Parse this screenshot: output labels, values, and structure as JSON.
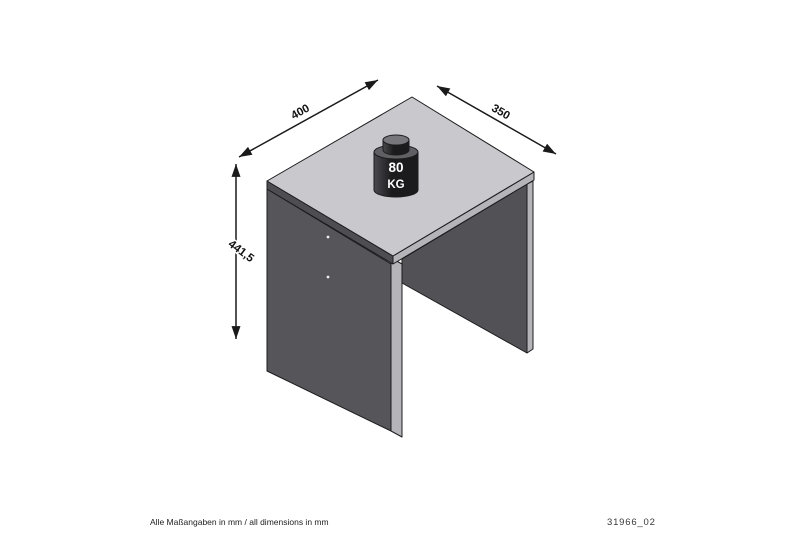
{
  "drawing": {
    "title": "stool isometric dimension drawing",
    "dimensions": {
      "width": {
        "label": "400"
      },
      "depth": {
        "label": "350"
      },
      "height": {
        "label": "441,5"
      }
    },
    "load_capacity": {
      "value": "80",
      "unit": "KG"
    },
    "colors": {
      "background": "#ffffff",
      "outline": "#1c1c1e",
      "dimension_line": "#1a1a1a",
      "top_surface": "#c9c9cd",
      "top_edge_dark": "#4e4e52",
      "top_edge_light": "#b5b5b9",
      "left_panel": "#56565a",
      "right_panel": "#525256",
      "edge_strip": "#b5b5b9",
      "screw_dot": "#ededf0",
      "weight_body_dark": "#1b1b1e",
      "weight_body_light": "#4a4a4e",
      "weight_rim": "#606064",
      "weight_knob_top": "#77777b",
      "weight_text": "#ffffff"
    }
  },
  "footer": {
    "note": "Alle Maßangaben in mm / all dimensions in mm",
    "drawing_number": "31966_02"
  }
}
